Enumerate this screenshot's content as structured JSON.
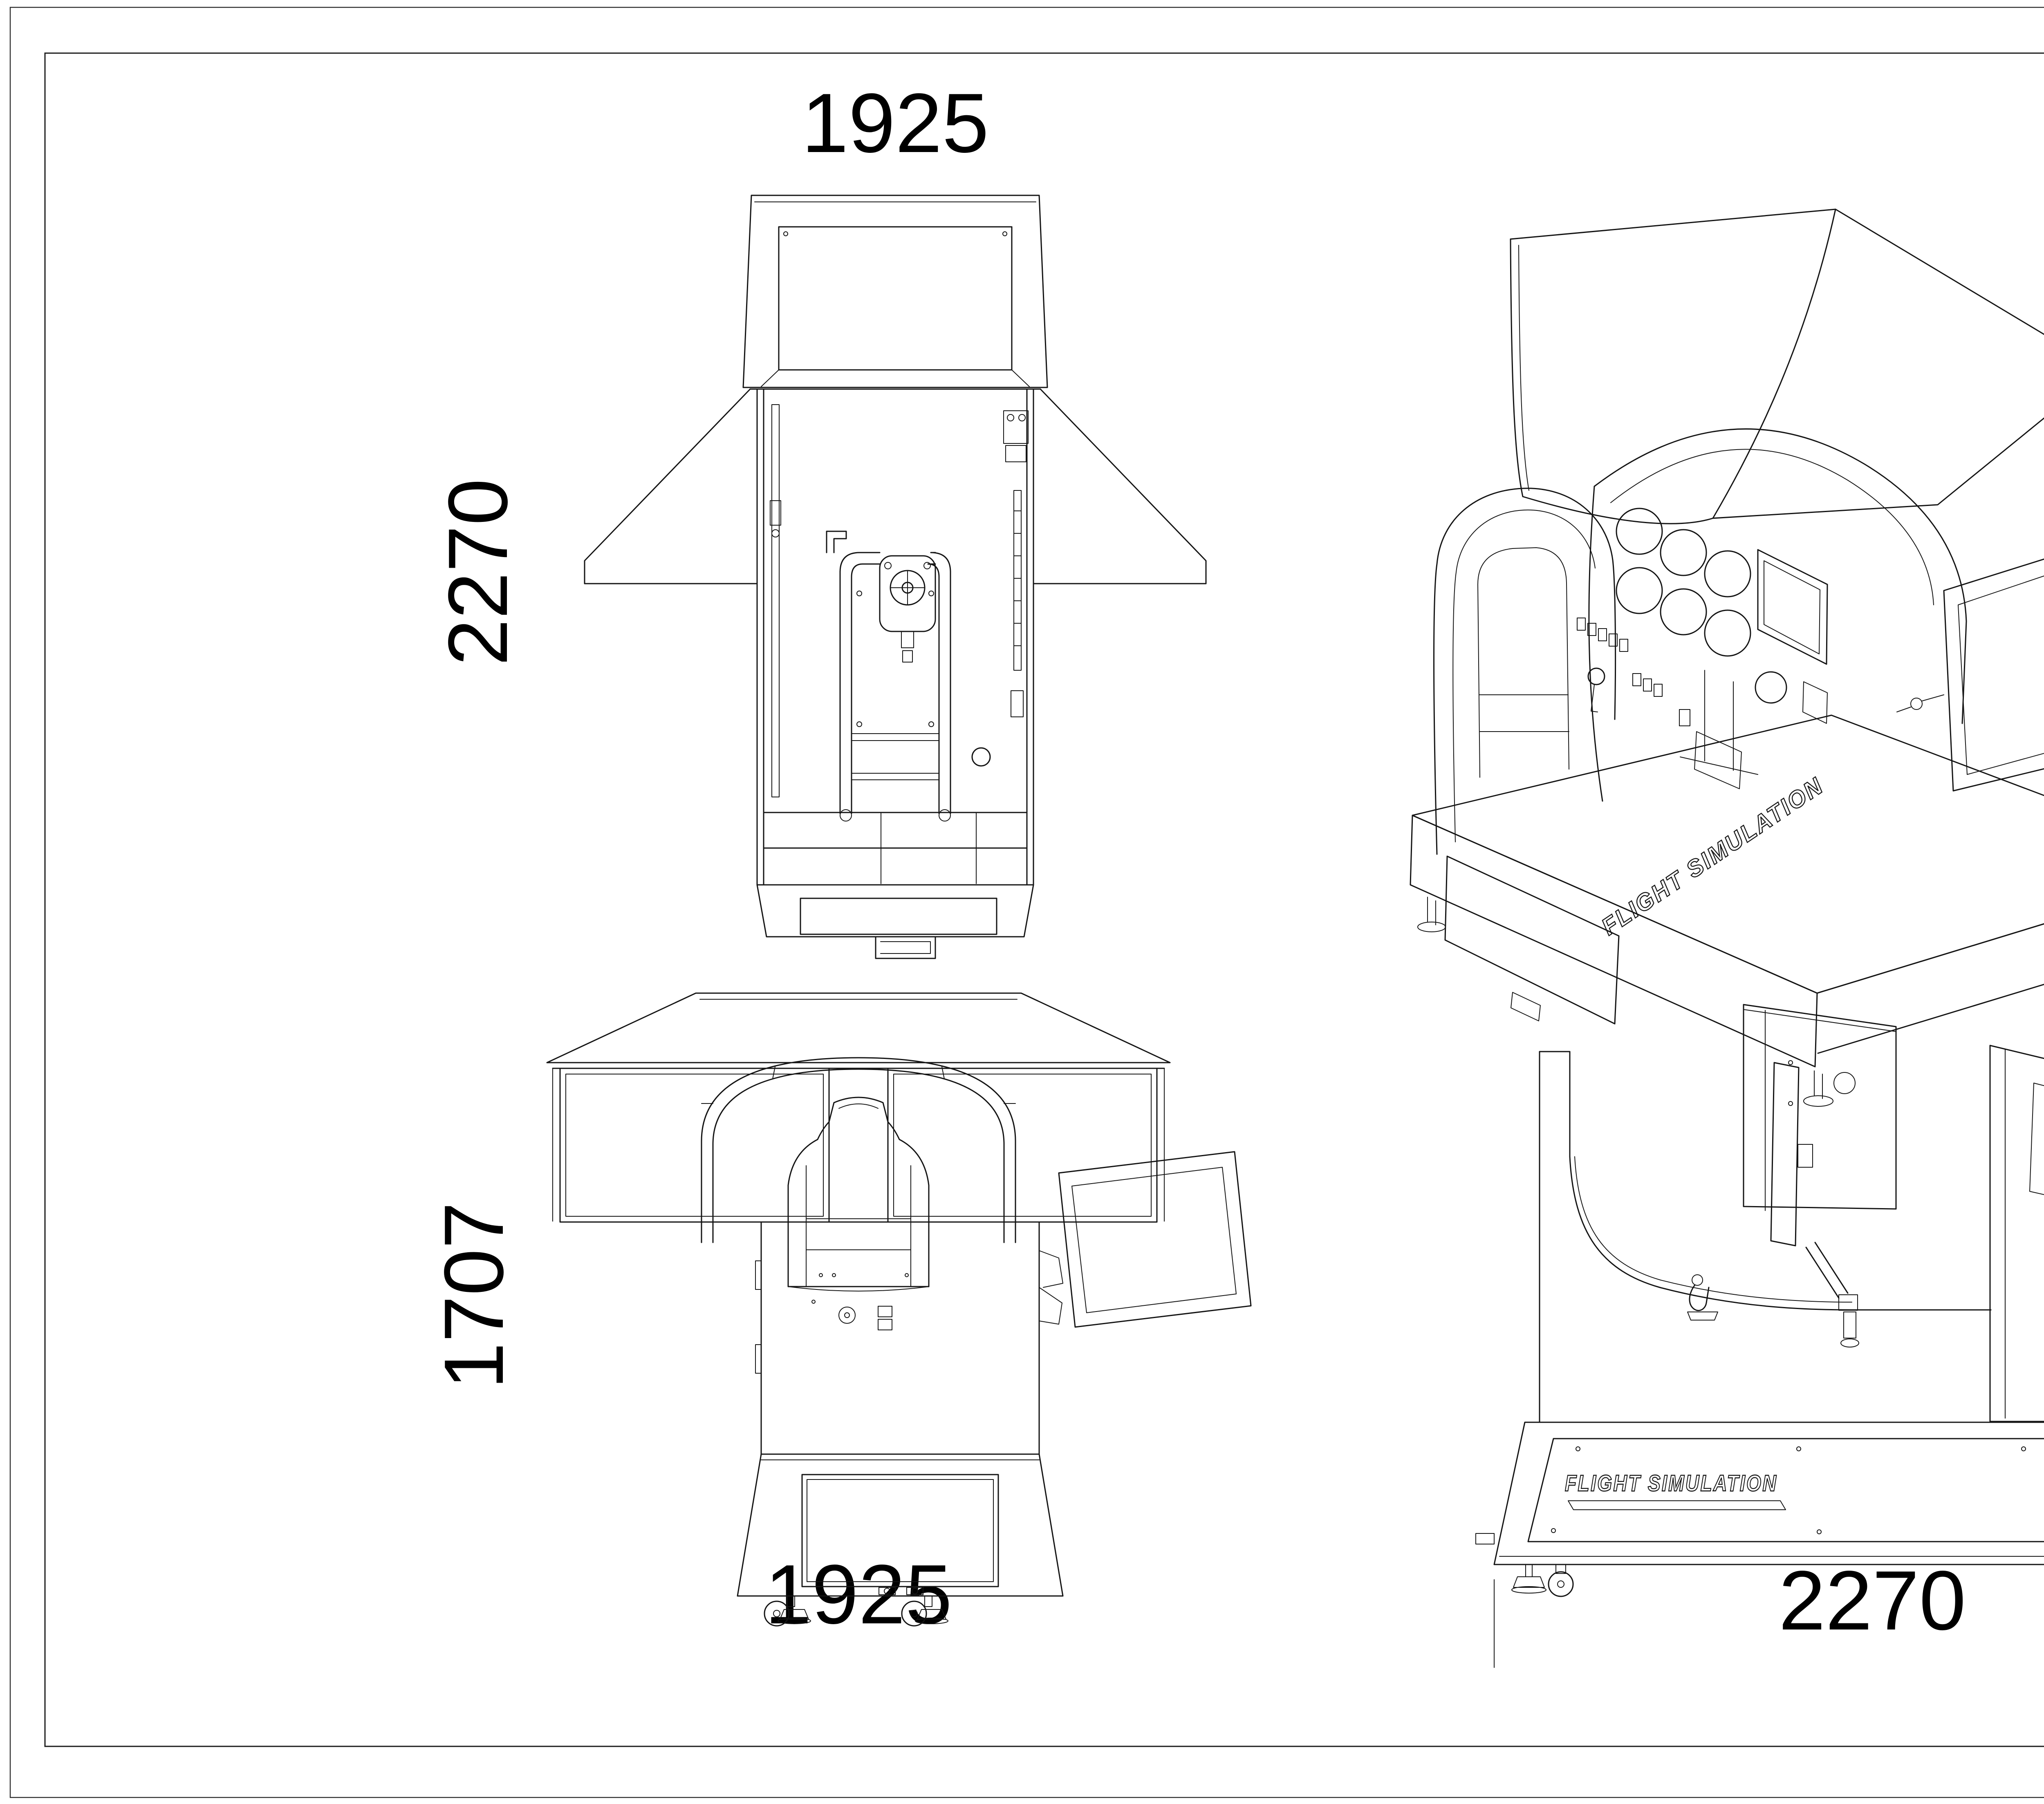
{
  "title_block": {
    "title": "DA40三视图"
  },
  "views": {
    "top": {
      "label": "top-view",
      "width_label": "1925",
      "depth_label": "2270"
    },
    "iso": {
      "label": "isometric-view",
      "brand_label": "FLIGHT SIMULATION"
    },
    "front": {
      "label": "front-view",
      "height_label": "1707",
      "width_label": "1925"
    },
    "side": {
      "label": "side-view",
      "height_label": "1707",
      "length_label": "2270",
      "brand_label": "FLIGHT SIMULATION"
    }
  }
}
